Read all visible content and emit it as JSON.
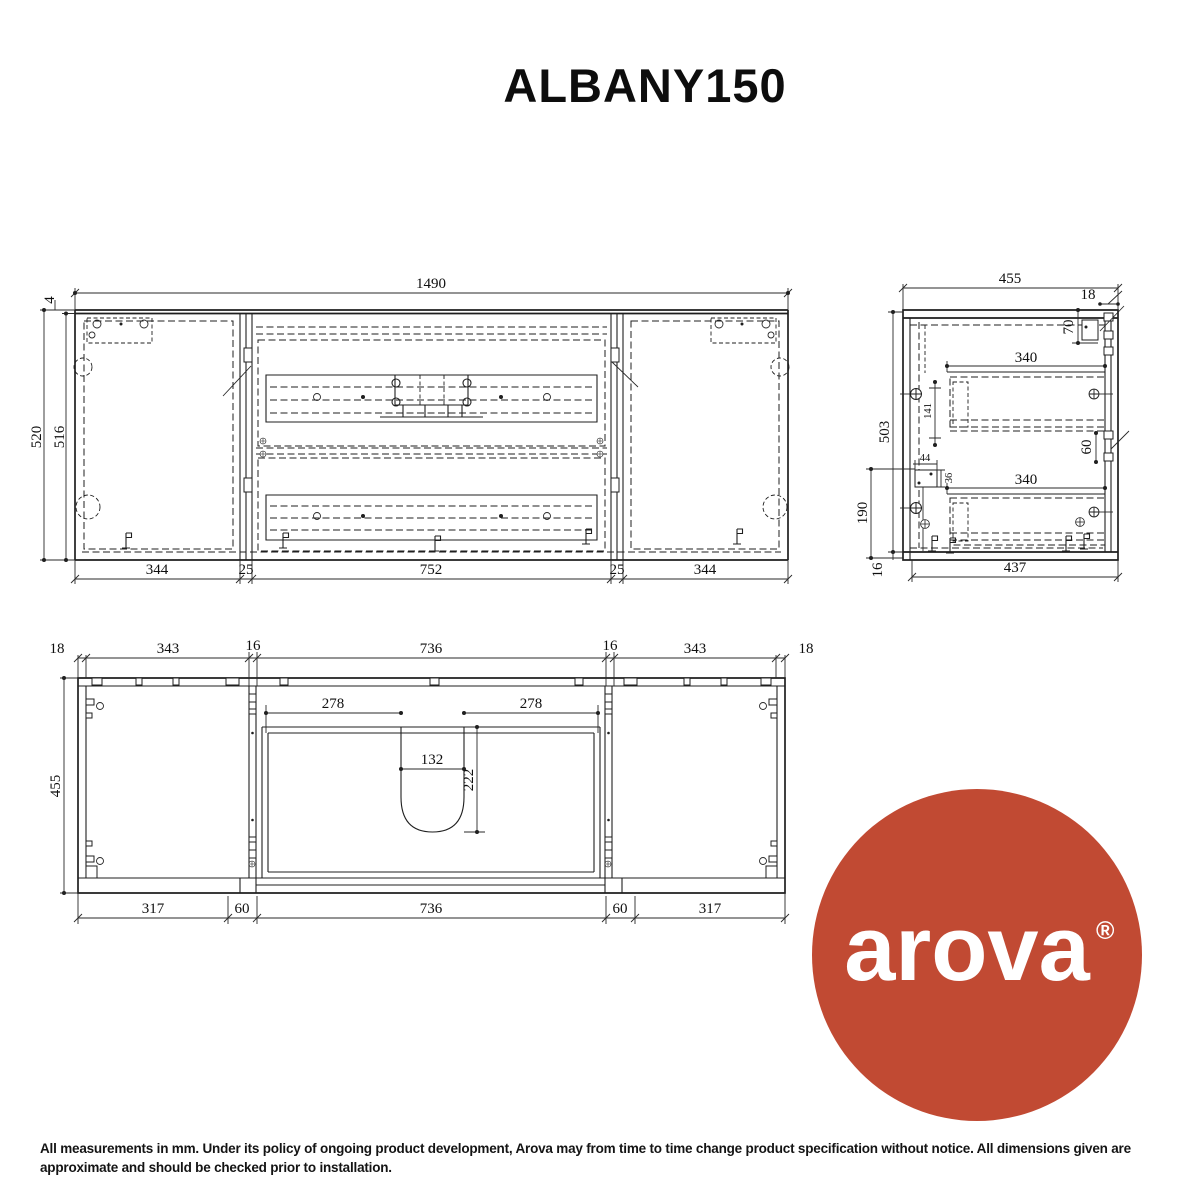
{
  "title": "ALBANY150",
  "views": {
    "front": {
      "dims": {
        "total_width": "1490",
        "top_gap": "4",
        "height_overall": "520",
        "height_cabinet": "516",
        "bottom": [
          "344",
          "25",
          "752",
          "25",
          "344"
        ]
      }
    },
    "side": {
      "dims": {
        "depth": "455",
        "back_offset": "18",
        "bracket_drop": "70",
        "drawer_depth_upper": "340",
        "interior_height": "503",
        "slide_offset": "141",
        "cutout_width": "44",
        "cutout_height": "36",
        "cutout_from_bottom": "190",
        "bracket_gap": "60",
        "drawer_depth_lower": "340",
        "base_height": "16",
        "interior_depth": "437"
      }
    },
    "plan": {
      "dims": {
        "top": [
          "18",
          "343",
          "16",
          "736",
          "16",
          "343",
          "18"
        ],
        "depth": "455",
        "basin_offset_left": "278",
        "basin_offset_right": "278",
        "basin_width": "132",
        "basin_depth": "222",
        "bottom": [
          "317",
          "60",
          "736",
          "60",
          "317"
        ]
      }
    }
  },
  "logo": {
    "brand": "arova",
    "registered": "®",
    "bg_color": "#c14a33"
  },
  "footer": {
    "disclaimer": "All measurements in mm. Under its policy of ongoing product development, Arova may from time to time change product specification without notice.  All dimensions given are approximate and should be checked prior to installation."
  }
}
